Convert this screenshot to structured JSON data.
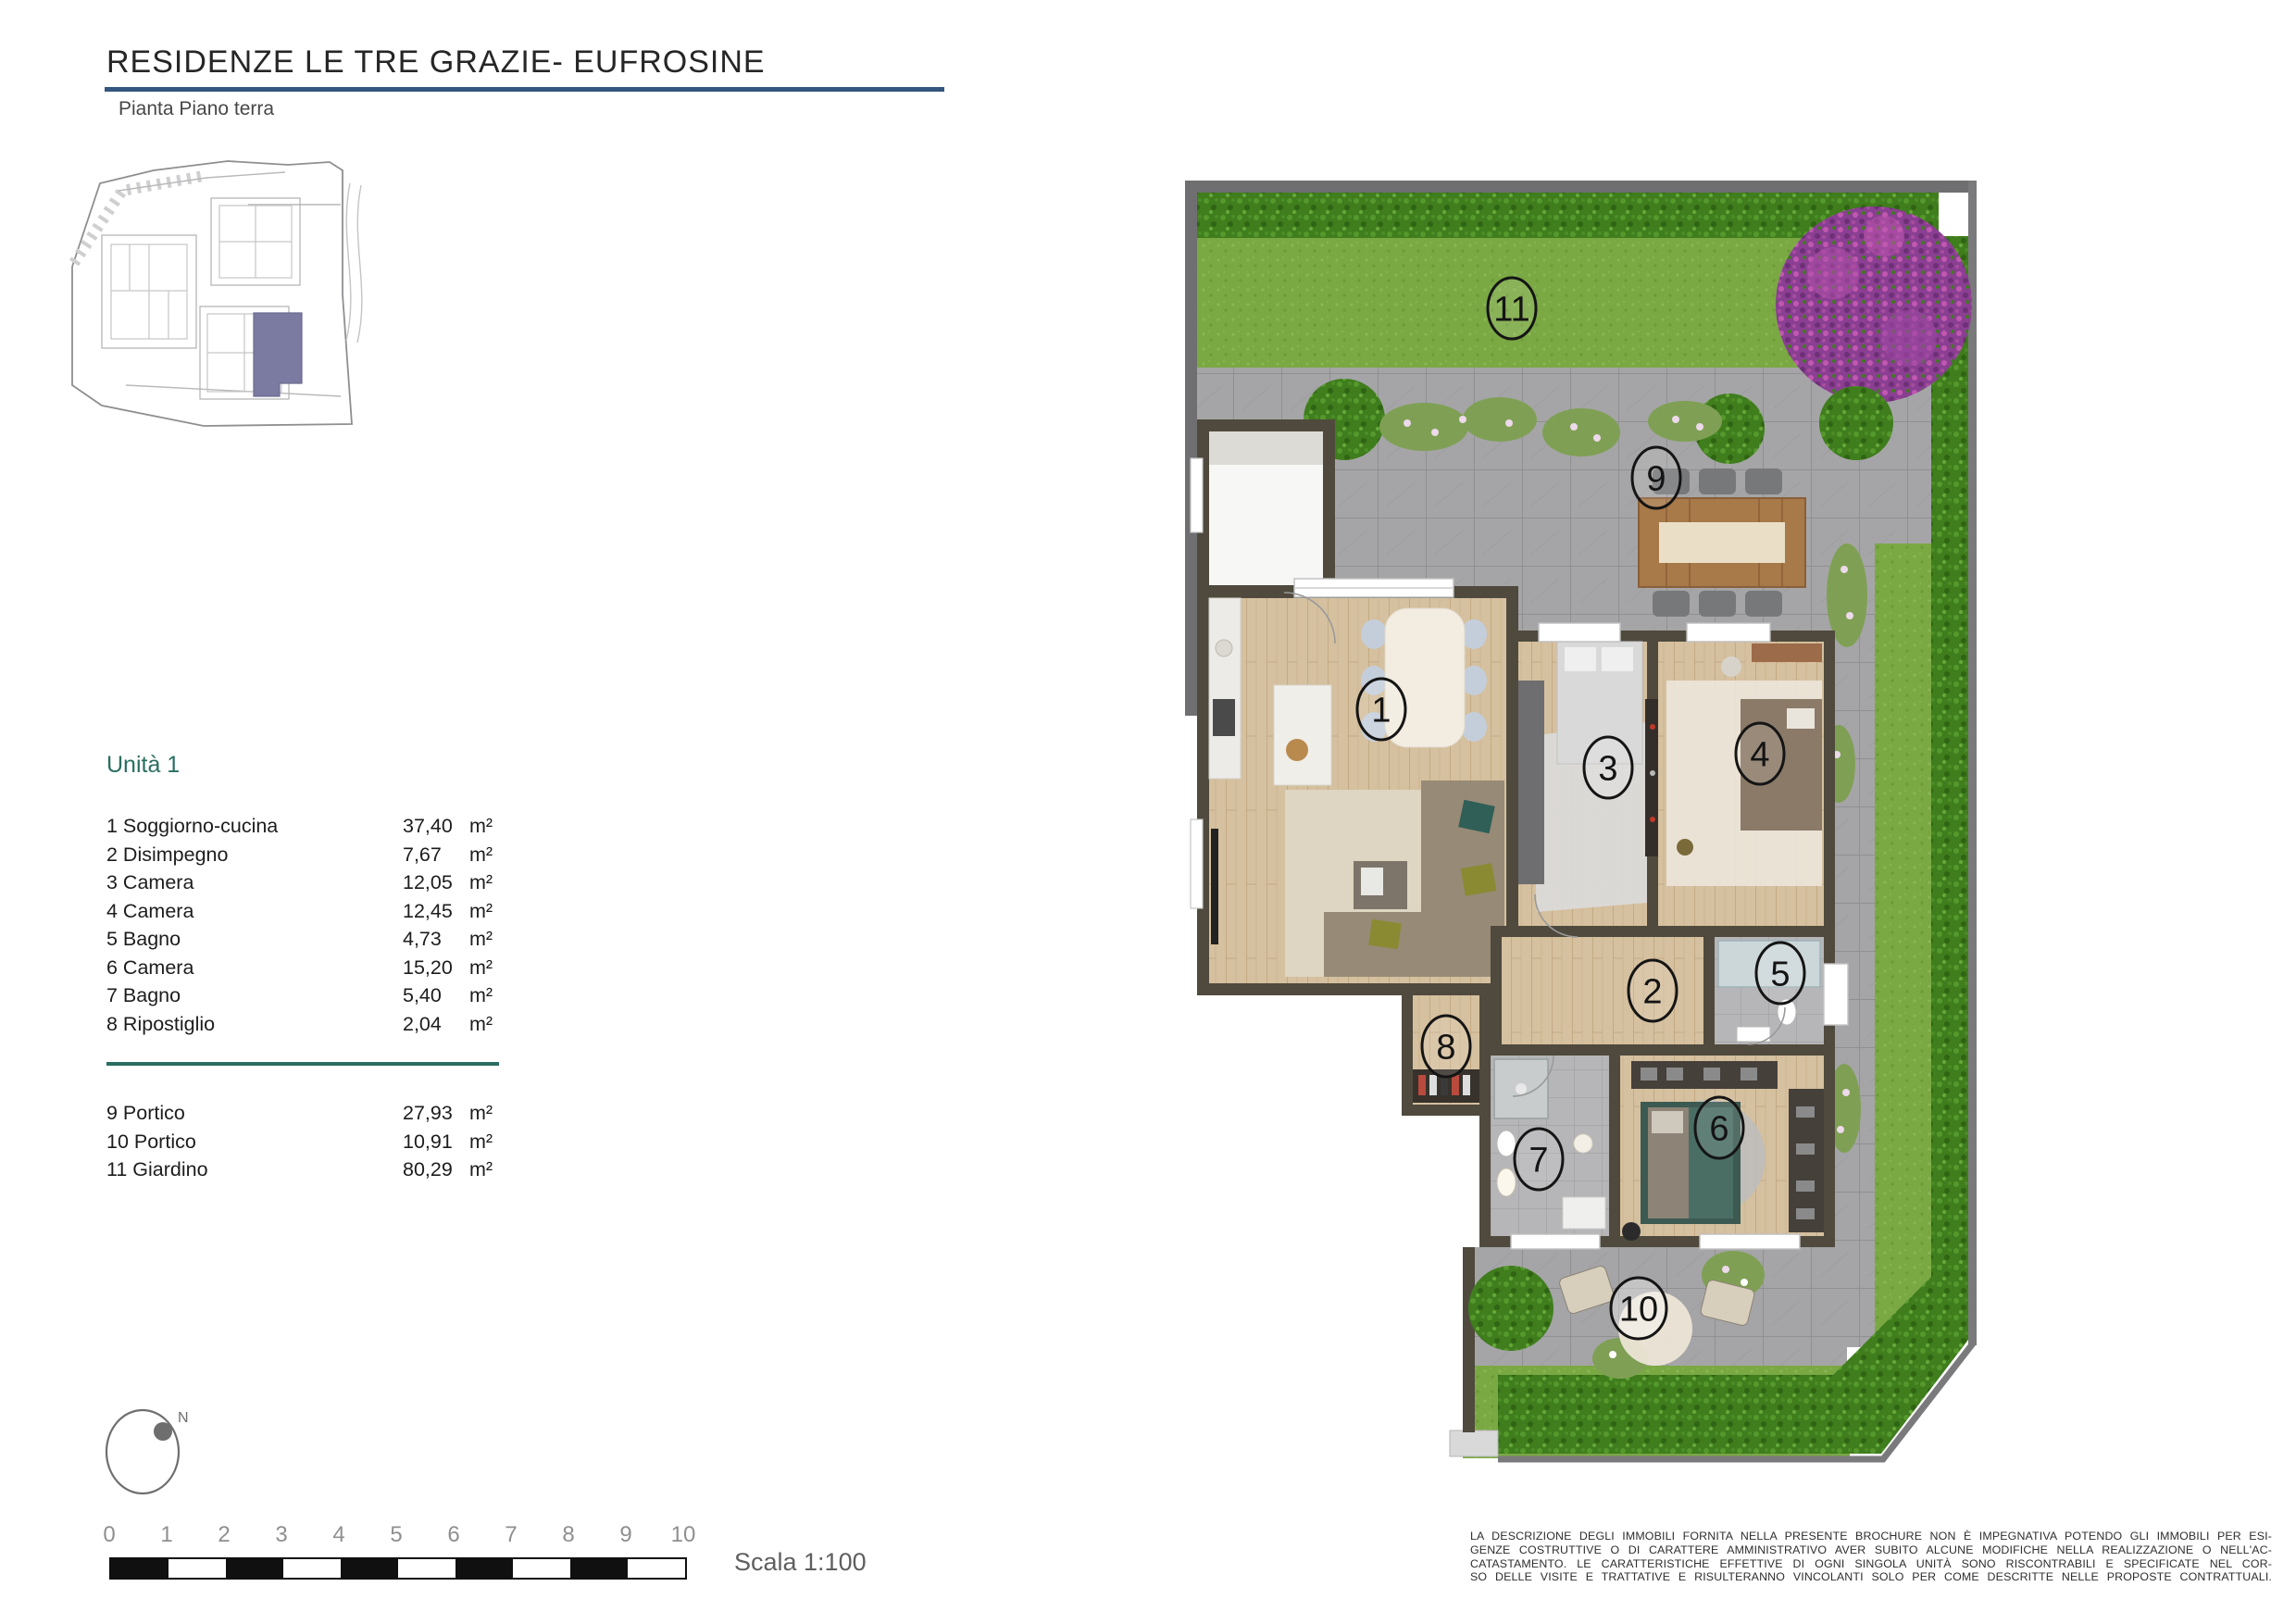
{
  "header": {
    "title": "RESIDENZE LE TRE GRAZIE- EUFROSINE",
    "subtitle": "Pianta Piano terra"
  },
  "legend": {
    "unit_title": "Unità 1",
    "rooms": [
      {
        "label": "1 Soggiorno-cucina",
        "area": "37,40",
        "unit": "m²"
      },
      {
        "label": "2 Disimpegno",
        "area": "7,67",
        "unit": "m²"
      },
      {
        "label": "3 Camera",
        "area": "12,05",
        "unit": "m²"
      },
      {
        "label": "4 Camera",
        "area": "12,45",
        "unit": "m²"
      },
      {
        "label": "5 Bagno",
        "area": "4,73",
        "unit": "m²"
      },
      {
        "label": "6 Camera",
        "area": "15,20",
        "unit": "m²"
      },
      {
        "label": "7 Bagno",
        "area": "5,40",
        "unit": "m²"
      },
      {
        "label": "8 Ripostiglio",
        "area": "2,04",
        "unit": "m²"
      }
    ],
    "outdoor": [
      {
        "label": "9 Portico",
        "area": "27,93",
        "unit": "m²"
      },
      {
        "label": "10 Portico",
        "area": "10,91",
        "unit": "m²"
      },
      {
        "label": "11 Giardino",
        "area": "80,29",
        "unit": "m²"
      }
    ]
  },
  "scalebar": {
    "ticks": [
      "0",
      "1",
      "2",
      "3",
      "4",
      "5",
      "6",
      "7",
      "8",
      "9",
      "10"
    ],
    "label": "Scala 1:100"
  },
  "north": {
    "label": "N"
  },
  "plan": {
    "badges": [
      {
        "n": "1"
      },
      {
        "n": "2"
      },
      {
        "n": "3"
      },
      {
        "n": "4"
      },
      {
        "n": "5"
      },
      {
        "n": "6"
      },
      {
        "n": "7"
      },
      {
        "n": "8"
      },
      {
        "n": "9"
      },
      {
        "n": "10"
      },
      {
        "n": "11"
      }
    ]
  },
  "disclaimer": {
    "lines": [
      "LA DESCRIZIONE DEGLI IMMOBILI FORNITA NELLA PRESENTE BROCHURE NON È IMPEGNATIVA POTENDO GLI IMMOBILI PER ESI-",
      "GENZE COSTRUTTIVE O DI CARATTERE AMMINISTRATIVO AVER SUBITO ALCUNE MODIFICHE NELLA REALIZZAZIONE O NELL'AC-",
      "CATASTAMENTO. LE CARATTERISTICHE EFFETTIVE DI OGNI SINGOLA UNITÀ SONO RISCONTRABILI E SPECIFICATE NEL COR-",
      "SO DELLE VISITE E TRATTATIVE E RISULTERANNO VINCOLANTI SOLO PER COME DESCRITTE NELLE PROPOSTE CONTRATTUALI."
    ]
  },
  "colors": {
    "title_underline": "#33567e",
    "unit_teal": "#2a6e61",
    "minimap_highlight": "#7b7aa0",
    "wall": "#4f4a3d",
    "lawn": "#7aa843",
    "hedge": "#3f7d1d",
    "paving": "#a5a5a7",
    "purple_bush": "#8a3f92"
  }
}
